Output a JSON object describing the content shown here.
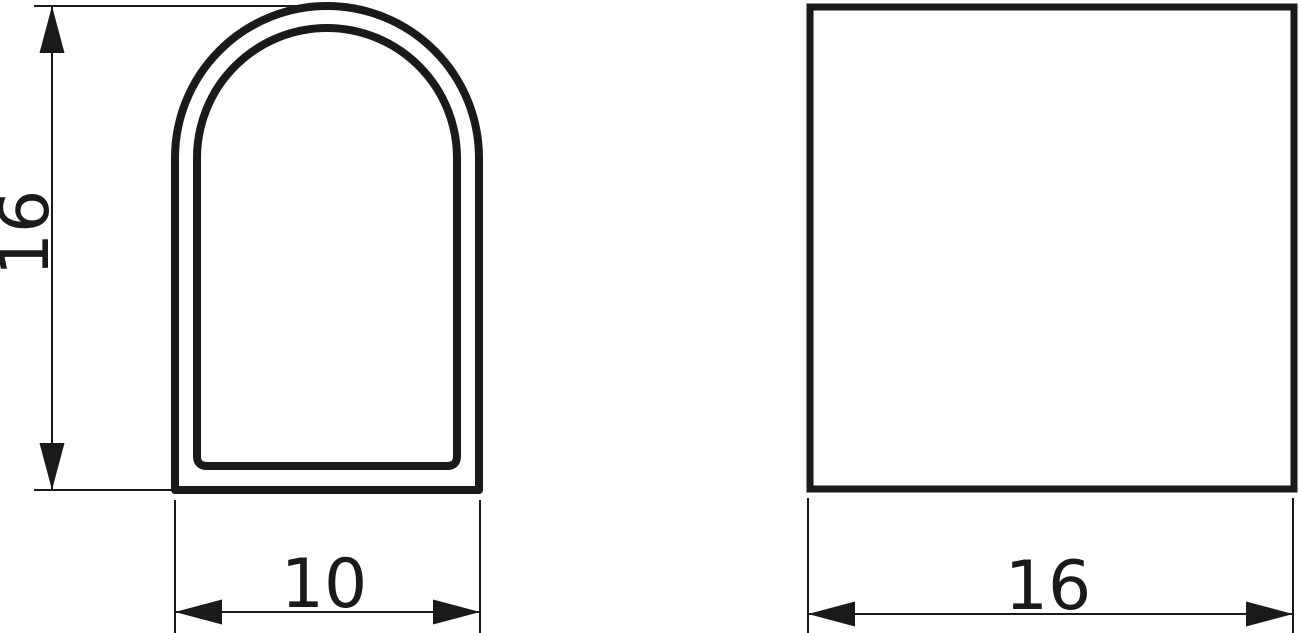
{
  "drawing": {
    "type": "technical-drawing",
    "background_color": "#ffffff",
    "line_color": "#1a1a1a",
    "front_view": {
      "shape": "arched-hollow-profile",
      "height_dimension": {
        "value": "16",
        "orientation": "vertical"
      },
      "width_dimension": {
        "value": "10",
        "orientation": "horizontal"
      }
    },
    "side_view": {
      "shape": "square",
      "width_dimension": {
        "value": "16",
        "orientation": "horizontal"
      }
    }
  }
}
